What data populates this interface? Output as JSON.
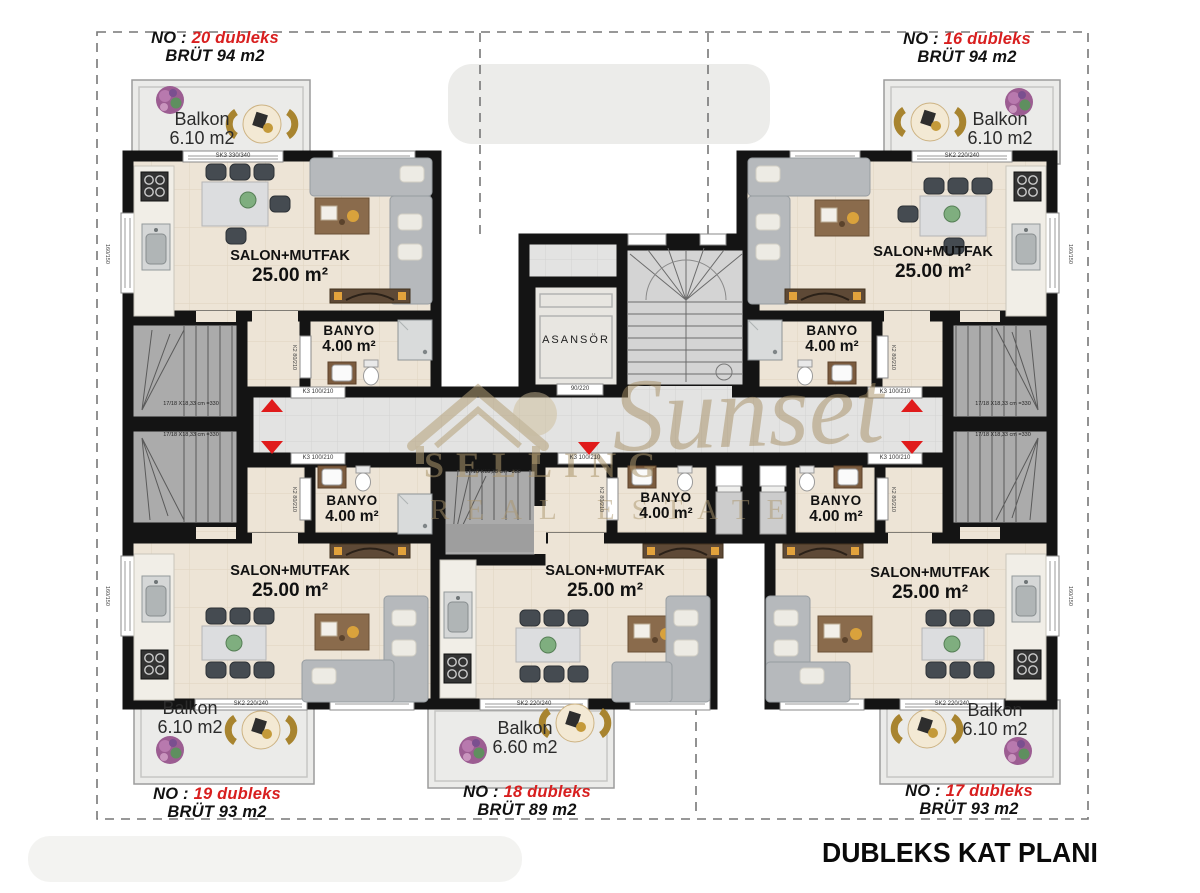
{
  "title": "DUBLEKS KAT PLANI",
  "watermark": {
    "name": "SELLING",
    "script": "Sunset",
    "tagline": "REAL ESTATE"
  },
  "common": {
    "elevator": "ASANSÖR",
    "elevator_door": "90/220",
    "salon": "SALON+MUTFAK",
    "salon_area": "25.00 m²",
    "banyo": "BANYO",
    "banyo_area": "4.00 m²",
    "balkon": "Balkon",
    "entry_door": "K3 100/210",
    "banyo_door": "K2 80/210",
    "balcony_door": "SK2 220/240",
    "balcony_door_large": "SK3 330/340",
    "stair_dim": "17/18 X18,33 cm =330",
    "window_dim": "160/150"
  },
  "units": [
    {
      "no": "NO :",
      "num": "20 dubleks",
      "brut": "BRÜT 94 m2",
      "balkon_area": "6.10 m2"
    },
    {
      "no": "NO :",
      "num": "16 dubleks",
      "brut": "BRÜT 94 m2",
      "balkon_area": "6.10 m2"
    },
    {
      "no": "NO :",
      "num": "19 dubleks",
      "brut": "BRÜT 93 m2",
      "balkon_area": "6.10 m2"
    },
    {
      "no": "NO :",
      "num": "18 dubleks",
      "brut": "BRÜT 89 m2",
      "balkon_area": "6.60 m2"
    },
    {
      "no": "NO :",
      "num": "17 dubleks",
      "brut": "BRÜT 93 m2",
      "balkon_area": "6.10 m2"
    }
  ]
}
